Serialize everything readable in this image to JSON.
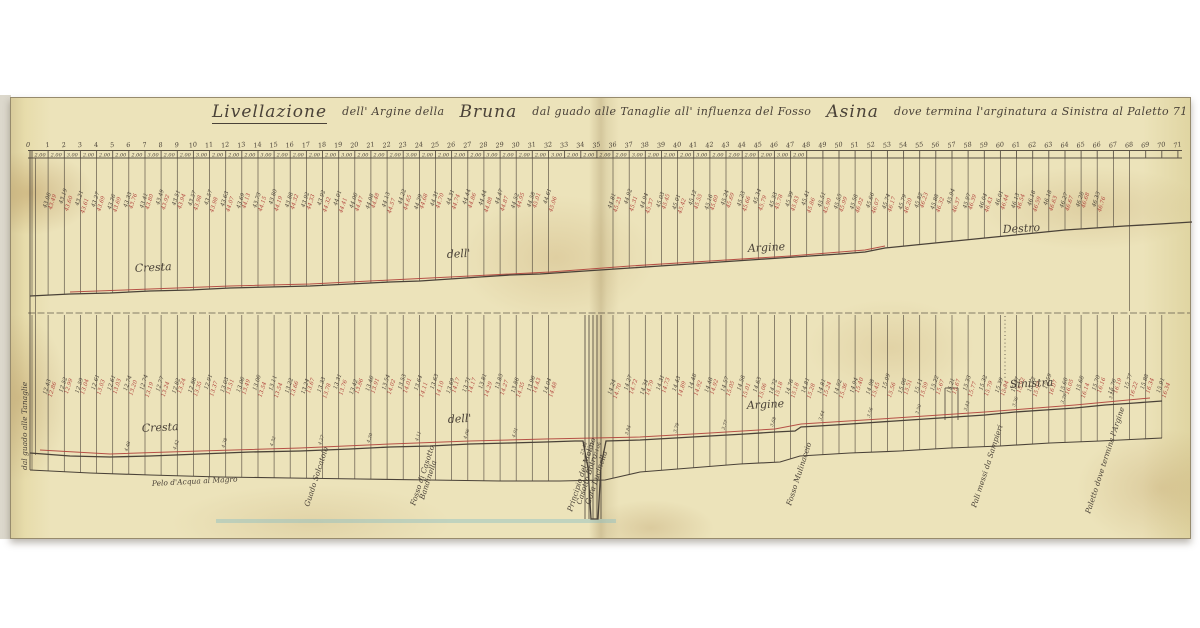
{
  "document": {
    "title": {
      "p1": "Livellazione",
      "p2": "dell' Argine della",
      "p3": "Bruna",
      "p4": "dal guado alle Tanaglie all' influenza del Fosso",
      "p5": "Asina",
      "p6": "dove termina l'arginatura a Sinistra al Paletto 71"
    }
  },
  "chart_data": {
    "type": "line",
    "title": "Livellazione dell' Argine della Bruna dal guado alle Tanaglie all' influenza del Fosso Asina dove termina l'arginatura a Sinistra al Paletto 71",
    "stations": {
      "first": 1,
      "last": 71,
      "count": 71,
      "zero_label": "0"
    },
    "distances": [
      "2.00",
      "2.00",
      "3.00",
      "2.00",
      "2.00",
      "2.00",
      "2.00",
      "3.00",
      "2.00",
      "2.00",
      "3.00",
      "2.00",
      "2.00",
      "2.00",
      "3.00",
      "2.00",
      "2.00",
      "2.00",
      "2.00",
      "3.00",
      "2.00",
      "2.00",
      "2.00",
      "3.00",
      "2.00",
      "2.00",
      "2.00",
      "2.00",
      "3.00",
      "2.00",
      "2.00",
      "2.00",
      "3.00",
      "2.00",
      "2.00",
      "2.00",
      "2.00",
      "3.00",
      "2.00",
      "2.00",
      "2.00",
      "3.00",
      "2.00",
      "2.00",
      "2.00",
      "2.00",
      "3.00",
      "2.00"
    ],
    "readings": {
      "upper": {
        "black_base": 43.05,
        "step": 0.05,
        "red_offset": 0.42
      },
      "lower": {
        "black_base": 12.4,
        "step": 0.05,
        "red_offset": 0.45
      },
      "bank_heights": {
        "base": 4.6,
        "step": -0.02,
        "stations": [
          6,
          9,
          12,
          15,
          18,
          21,
          24,
          27,
          30,
          37,
          40,
          43,
          46,
          49,
          52,
          55,
          58,
          61,
          64,
          67
        ]
      },
      "estimated": true
    },
    "cluster": {
      "x": [
        585,
        589,
        593,
        597,
        601
      ],
      "top": 315,
      "depth_to": 519,
      "readings": [
        "23.48",
        "23.52",
        "24.06"
      ]
    },
    "profiles": {
      "upper_black": [
        [
          30,
          296
        ],
        [
          70,
          294
        ],
        [
          110,
          293
        ],
        [
          150,
          291
        ],
        [
          190,
          290
        ],
        [
          230,
          288
        ],
        [
          270,
          287
        ],
        [
          310,
          286
        ],
        [
          350,
          284
        ],
        [
          390,
          282
        ],
        [
          420,
          281
        ],
        [
          450,
          279
        ],
        [
          480,
          277
        ],
        [
          510,
          275
        ],
        [
          540,
          274
        ],
        [
          570,
          272
        ],
        [
          600,
          270
        ],
        [
          630,
          268
        ],
        [
          660,
          266
        ],
        [
          690,
          264
        ],
        [
          720,
          262
        ],
        [
          750,
          260
        ],
        [
          780,
          258
        ],
        [
          810,
          256
        ],
        [
          840,
          254
        ],
        [
          865,
          252
        ],
        [
          885,
          248
        ],
        [
          915,
          245
        ],
        [
          945,
          242
        ],
        [
          975,
          239
        ],
        [
          1005,
          236
        ],
        [
          1035,
          233
        ],
        [
          1065,
          230
        ],
        [
          1095,
          228
        ],
        [
          1125,
          226
        ],
        [
          1160,
          224
        ],
        [
          1192,
          222
        ]
      ],
      "upper_red": [
        [
          70,
          292
        ],
        [
          150,
          289
        ],
        [
          230,
          286
        ],
        [
          310,
          284
        ],
        [
          390,
          280
        ],
        [
          470,
          276
        ],
        [
          550,
          272
        ],
        [
          630,
          266
        ],
        [
          710,
          261
        ],
        [
          790,
          256
        ],
        [
          865,
          250
        ],
        [
          885,
          246
        ]
      ],
      "lower_black": [
        [
          30,
          453
        ],
        [
          70,
          456
        ],
        [
          110,
          457
        ],
        [
          150,
          456
        ],
        [
          200,
          454
        ],
        [
          250,
          452
        ],
        [
          300,
          451
        ],
        [
          350,
          449
        ],
        [
          390,
          447
        ],
        [
          430,
          446
        ],
        [
          470,
          444
        ],
        [
          510,
          443
        ],
        [
          545,
          442
        ],
        [
          575,
          441
        ],
        [
          583,
          441
        ],
        [
          588,
          468
        ],
        [
          591,
          519
        ],
        [
          598,
          519
        ],
        [
          601,
          466
        ],
        [
          606,
          441
        ],
        [
          640,
          440
        ],
        [
          675,
          438
        ],
        [
          710,
          436
        ],
        [
          745,
          434
        ],
        [
          775,
          432
        ],
        [
          795,
          431
        ],
        [
          801,
          427
        ],
        [
          835,
          425
        ],
        [
          865,
          423
        ],
        [
          895,
          421
        ],
        [
          925,
          419
        ],
        [
          955,
          417
        ],
        [
          985,
          415
        ],
        [
          1015,
          412
        ],
        [
          1045,
          410
        ],
        [
          1075,
          408
        ],
        [
          1105,
          405
        ],
        [
          1135,
          403
        ],
        [
          1162,
          401
        ]
      ],
      "lower_red": [
        [
          40,
          450
        ],
        [
          110,
          454
        ],
        [
          200,
          451
        ],
        [
          300,
          448
        ],
        [
          390,
          444
        ],
        [
          470,
          441
        ],
        [
          545,
          439
        ],
        [
          640,
          437
        ],
        [
          710,
          433
        ],
        [
          775,
          429
        ],
        [
          801,
          424
        ],
        [
          895,
          418
        ],
        [
          985,
          412
        ],
        [
          1075,
          405
        ],
        [
          1150,
          398
        ]
      ],
      "band_bottom": [
        [
          30,
          470
        ],
        [
          90,
          473
        ],
        [
          150,
          475
        ],
        [
          220,
          477
        ],
        [
          290,
          478
        ],
        [
          360,
          479
        ],
        [
          430,
          480
        ],
        [
          500,
          481
        ],
        [
          560,
          481
        ],
        [
          605,
          480
        ],
        [
          640,
          472
        ],
        [
          690,
          468
        ],
        [
          740,
          464
        ],
        [
          780,
          462
        ],
        [
          800,
          456
        ],
        [
          850,
          453
        ],
        [
          900,
          451
        ],
        [
          950,
          448
        ],
        [
          1000,
          446
        ],
        [
          1050,
          443
        ],
        [
          1100,
          441
        ],
        [
          1162,
          438
        ]
      ]
    },
    "layout": {
      "ruler_y": [
        150,
        158
      ],
      "datum_y": 313,
      "x0": 32,
      "dx": 16.14,
      "band2_top": 315,
      "dotted_x": 1005,
      "grid": "station-verticals",
      "legend": "none"
    },
    "labels": {
      "upper": [
        {
          "t": "Cresta",
          "x": 135,
          "y": 272
        },
        {
          "t": "dell'",
          "x": 447,
          "y": 258
        },
        {
          "t": "Argine",
          "x": 748,
          "y": 252
        },
        {
          "t": "Destro",
          "x": 1003,
          "y": 233
        }
      ],
      "lower": [
        {
          "t": "Cresta",
          "x": 142,
          "y": 432
        },
        {
          "t": "dell'",
          "x": 448,
          "y": 423
        },
        {
          "t": "Argine",
          "x": 747,
          "y": 409
        },
        {
          "t": "Sinistra",
          "x": 1010,
          "y": 388
        }
      ]
    },
    "notes": [
      {
        "t": "dal guado alle Tanaglie",
        "x": 27,
        "y": 470,
        "r": -90
      },
      {
        "t": "Pelo d'Acqua al Magro",
        "x": 152,
        "y": 486,
        "r": -3
      },
      {
        "t": "Guado Solcatoio",
        "x": 309,
        "y": 507,
        "r": -72
      },
      {
        "t": "Fosso di Casotto",
        "x": 415,
        "y": 506,
        "r": -72
      },
      {
        "t": "Bandinella",
        "x": 424,
        "y": 500,
        "r": -72
      },
      {
        "t": "Principio del Molino",
        "x": 572,
        "y": 512,
        "r": -72
      },
      {
        "t": "Casotto Botro",
        "x": 581,
        "y": 505,
        "r": -72
      },
      {
        "t": "Gora Lucinella",
        "x": 590,
        "y": 505,
        "r": -72
      },
      {
        "t": "Fosso Mulinaccio",
        "x": 791,
        "y": 506,
        "r": -72
      },
      {
        "t": "Pali messi da Sampieri",
        "x": 976,
        "y": 508,
        "r": -72
      },
      {
        "t": "Paletto dove termina l'Argine",
        "x": 1090,
        "y": 514,
        "r": -72
      }
    ],
    "colors": {
      "ink": "#4a4238",
      "red": "#b0403a",
      "paper": "#ece3ba"
    }
  }
}
